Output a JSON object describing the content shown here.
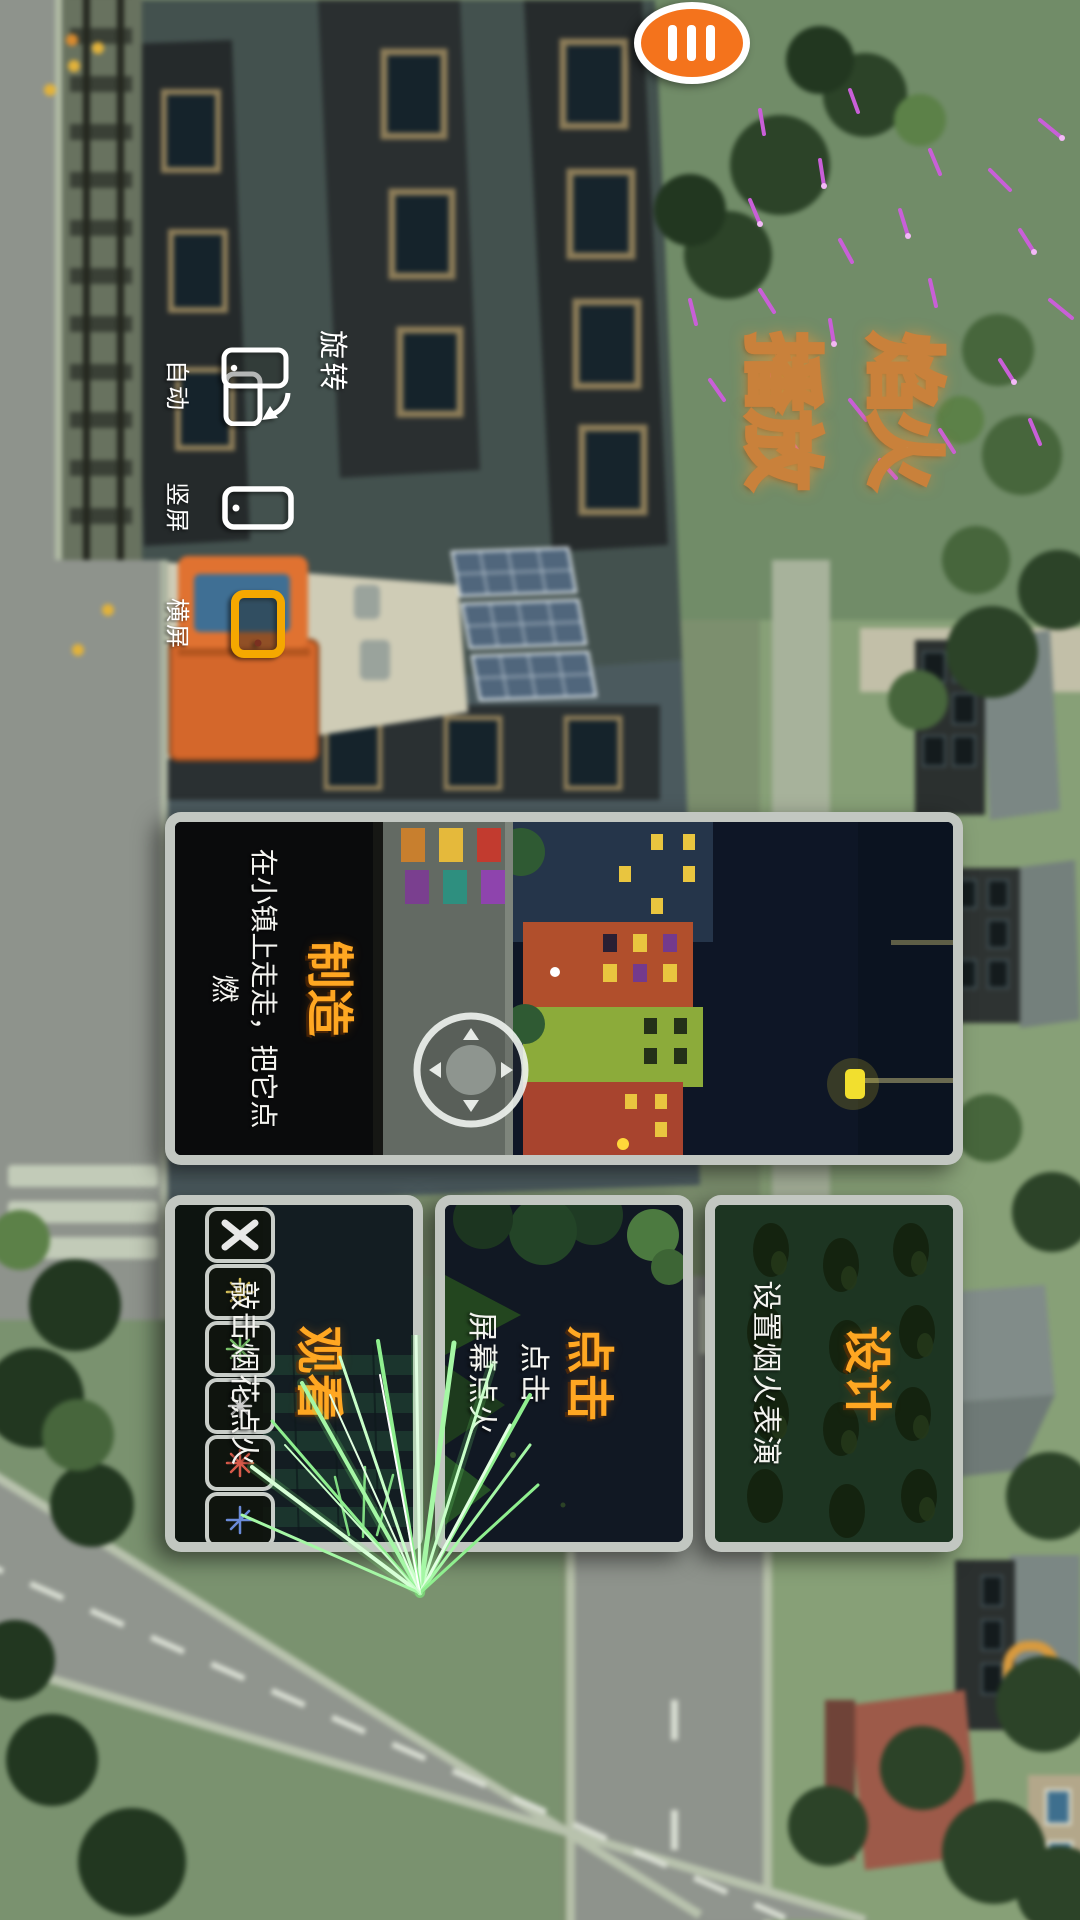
{
  "app": {
    "name": "fireworks-play-game-menu",
    "title": {
      "line1": "焰火",
      "line2": "播放"
    },
    "menu_button": {
      "icon": "hamburger-icon"
    }
  },
  "rotation_control": {
    "label": "旋转",
    "options": [
      {
        "id": "auto",
        "label": "自动",
        "icon": "auto-rotate-icon",
        "selected": false
      },
      {
        "id": "portrait",
        "label": "竖屏",
        "icon": "portrait-phone-icon",
        "selected": false
      },
      {
        "id": "landscape",
        "label": "横屏",
        "icon": "landscape-phone-icon",
        "selected": true
      }
    ]
  },
  "mode_cards": {
    "create": {
      "title": "制造",
      "description": "在小镇上走走，把它点燃",
      "preview": "night-town-with-joystick"
    },
    "design": {
      "title": "设计",
      "subtitle": "设置烟火表演",
      "preview": "firework-launcher-field"
    },
    "tap": {
      "title": "点击",
      "subtitle_line1": "点击",
      "subtitle_line2": "屏幕点火",
      "preview": "night-sky-with-trees"
    },
    "watch": {
      "title": "观看",
      "subtitle": "敲击烟花点火",
      "preview": "firework-show-with-slot-toolbar"
    }
  },
  "colors": {
    "accent_orange": "#f4731c",
    "selected_icon_orange": "#f5a800",
    "card_title_orange": "#ffa722",
    "title_fill": "#fff6e6",
    "title_outline": "#c9813b",
    "card_border": "#c9cec9",
    "subtitle_white": "#f2f2f2",
    "spark_purple": "#c95fd8",
    "trail_green": "#8fef8f"
  }
}
